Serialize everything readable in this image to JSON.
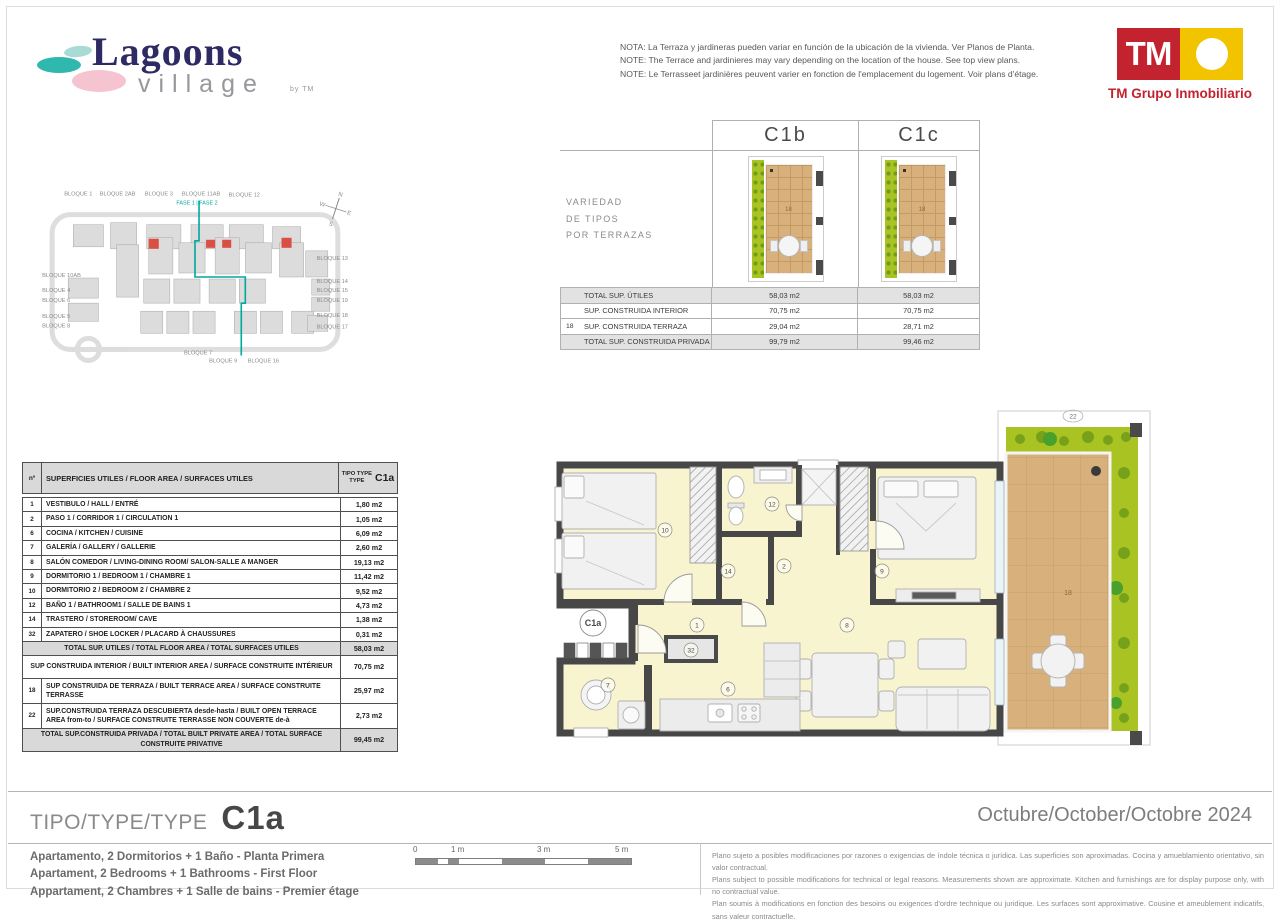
{
  "brand": {
    "name": "Lagoons",
    "sub": "village",
    "by": "by TM",
    "tm": "TM",
    "company": "TM Grupo Inmobiliario"
  },
  "notes": [
    "NOTA: La Terraza y jardineras pueden variar en función de la ubicación de la vivienda. Ver Planos de Planta.",
    "NOTE: The Terrace and jardinieres may vary depending on the location of the house. See top view plans.",
    "NOTE: Le Terrasseet jardinières peuvent varier en fonction de l'emplacement du logement. Voir plans d'étage."
  ],
  "site_plan": {
    "fase": "FASE 1 | FASE 2",
    "compass": {
      "n": "N",
      "s": "S",
      "e": "E",
      "w": "W"
    },
    "labels": [
      {
        "text": "BLOQUE 1",
        "x": 50,
        "y": 13,
        "anchor": "middle"
      },
      {
        "text": "BLOQUE 2AB",
        "x": 89,
        "y": 13,
        "anchor": "middle"
      },
      {
        "text": "BLOQUE 3",
        "x": 130,
        "y": 13,
        "anchor": "middle"
      },
      {
        "text": "BLOQUE 11AB",
        "x": 172,
        "y": 13,
        "anchor": "middle"
      },
      {
        "text": "BLOQUE 12",
        "x": 215,
        "y": 14,
        "anchor": "middle"
      },
      {
        "text": "BLOQUE 10AB",
        "x": 14,
        "y": 94,
        "anchor": "start"
      },
      {
        "text": "BLOQUE 4",
        "x": 14,
        "y": 109,
        "anchor": "start"
      },
      {
        "text": "BLOQUE 6",
        "x": 14,
        "y": 119,
        "anchor": "start"
      },
      {
        "text": "BLOQUE 5",
        "x": 14,
        "y": 135,
        "anchor": "start"
      },
      {
        "text": "BLOQUE 8",
        "x": 14,
        "y": 144,
        "anchor": "start"
      },
      {
        "text": "BLOQUE 13",
        "x": 318,
        "y": 77,
        "anchor": "end"
      },
      {
        "text": "BLOQUE 14",
        "x": 318,
        "y": 100,
        "anchor": "end"
      },
      {
        "text": "BLOQUE 15",
        "x": 318,
        "y": 109,
        "anchor": "end"
      },
      {
        "text": "BLOQUE 19",
        "x": 318,
        "y": 119,
        "anchor": "end"
      },
      {
        "text": "BLOQUE 18",
        "x": 318,
        "y": 134,
        "anchor": "end"
      },
      {
        "text": "BLOQUE 17",
        "x": 318,
        "y": 145,
        "anchor": "end"
      },
      {
        "text": "BLOQUE 7",
        "x": 169,
        "y": 171,
        "anchor": "middle"
      },
      {
        "text": "BLOQUE 9",
        "x": 194,
        "y": 179,
        "anchor": "middle"
      },
      {
        "text": "BLOQUE 16",
        "x": 234,
        "y": 179,
        "anchor": "middle"
      }
    ]
  },
  "variants": {
    "heading": [
      "VARIEDAD",
      "DE TIPOS",
      "POR TERRAZAS"
    ],
    "columns": [
      "C1b",
      "C1c"
    ],
    "terrace_room_number": "18",
    "rows": [
      {
        "n": "",
        "label": "TOTAL SUP. ÚTILES",
        "c1b": "58,03 m2",
        "c1c": "58,03 m2",
        "shaded": true
      },
      {
        "n": "",
        "label": "SUP. CONSTRUIDA INTERIOR",
        "c1b": "70,75 m2",
        "c1c": "70,75 m2",
        "shaded": false
      },
      {
        "n": "18",
        "label": "SUP. CONSTRUIDA TERRAZA",
        "c1b": "29,04 m2",
        "c1c": "28,71 m2",
        "shaded": false
      },
      {
        "n": "",
        "label": "TOTAL SUP. CONSTRUIDA PRIVADA",
        "c1b": "99,79 m2",
        "c1c": "99,46 m2",
        "shaded": true
      }
    ]
  },
  "surfaces": {
    "col_n": "nº",
    "col_label": "SUPERFICIES UTILES / FLOOR AREA / SURFACES UTILES",
    "col_tipo_lines": [
      "TIPO TYPE",
      "TYPE"
    ],
    "col_tipo_value": "C1a",
    "rows": [
      {
        "n": "1",
        "label": "VESTIBULO / HALL / ENTRÉ",
        "value": "1,80 m2",
        "kind": "plain"
      },
      {
        "n": "2",
        "label": "PASO 1 / CORRIDOR 1 / CIRCULATION 1",
        "value": "1,05 m2",
        "kind": "plain"
      },
      {
        "n": "6",
        "label": "COCINA / KITCHEN / CUISINE",
        "value": "6,09 m2",
        "kind": "plain"
      },
      {
        "n": "7",
        "label": "GALERÍA / GALLERY / GALLERIE",
        "value": "2,60 m2",
        "kind": "plain"
      },
      {
        "n": "8",
        "label": "SALÓN COMEDOR  / LIVING-DINING ROOM/ SALON-SALLE A MANGER",
        "value": "19,13 m2",
        "kind": "plain"
      },
      {
        "n": "9",
        "label": "DORMITORIO 1 / BEDROOM 1 / CHAMBRE 1",
        "value": "11,42 m2",
        "kind": "plain"
      },
      {
        "n": "10",
        "label": "DORMITORIO 2 / BEDROOM 2 / CHAMBRE 2",
        "value": "9,52 m2",
        "kind": "plain"
      },
      {
        "n": "12",
        "label": "BAÑO 1 / BATHROOM1 / SALLE DE BAINS 1",
        "value": "4,73 m2",
        "kind": "plain"
      },
      {
        "n": "14",
        "label": "TRASTERO / STOREROOM/ CAVE",
        "value": "1,38 m2",
        "kind": "plain"
      },
      {
        "n": "32",
        "label": "ZAPATERO / SHOE LOCKER / PLACARD À CHAUSSURES",
        "value": "0,31 m2",
        "kind": "plain"
      },
      {
        "n": "",
        "label": "TOTAL SUP. UTILES / TOTAL FLOOR AREA / TOTAL SURFACES UTILES",
        "value": "58,03 m2",
        "kind": "total"
      },
      {
        "n": "",
        "label": "SUP CONSTRUIDA INTERIOR / BUILT INTERIOR AREA /  SURFACE CONSTRUITE INTÉRIEUR",
        "value": "70,75 m2",
        "kind": "center2"
      },
      {
        "n": "18",
        "label": "SUP CONSTRUIDA  DE TERRAZA  / BUILT TERRACE  AREA / SURFACE CONSTRUITE TERRASSE",
        "value": "25,97 m2",
        "kind": "tall"
      },
      {
        "n": "22",
        "label": "SUP.CONSTRUIDA TERRAZA DESCUBIERTA desde-hasta / BUILT OPEN TERRACE AREA from-to / SURFACE CONSTRUITE TERRASSE NON COUVERTE de-à",
        "value": "2,73 m2",
        "kind": "tall"
      },
      {
        "n": "",
        "label": "TOTAL SUP.CONSTRUIDA PRIVADA / TOTAL  BUILT PRIVATE AREA / TOTAL SURFACE CONSTRUITE PRIVATIVE",
        "value": "99,45 m2",
        "kind": "total"
      }
    ]
  },
  "floor_plan": {
    "unit": "C1a",
    "terrace_number": "18",
    "jardiniere_number": "22",
    "room_labels": [
      {
        "id": "10",
        "x": 125,
        "y": 127
      },
      {
        "id": "12",
        "x": 232,
        "y": 101
      },
      {
        "id": "14",
        "x": 188,
        "y": 168
      },
      {
        "id": "2",
        "x": 244,
        "y": 163
      },
      {
        "id": "9",
        "x": 342,
        "y": 168
      },
      {
        "id": "1",
        "x": 157,
        "y": 222
      },
      {
        "id": "32",
        "x": 151,
        "y": 247
      },
      {
        "id": "7",
        "x": 68,
        "y": 282
      },
      {
        "id": "6",
        "x": 188,
        "y": 286
      },
      {
        "id": "8",
        "x": 307,
        "y": 222
      }
    ]
  },
  "footer": {
    "type_prefix": "TIPO/TYPE/TYPE",
    "type_value": "C1a",
    "date": "Octubre/October/Octobre 2024",
    "descriptions": [
      "Apartamento, 2 Dormitorios + 1 Baño - Planta Primera",
      "Apartament, 2 Bedrooms + 1 Bathrooms - First Floor",
      "Appartament, 2 Chambres + 1 Salle de bains - Premier étage"
    ],
    "scale_ticks": [
      "0",
      "1 m",
      "3 m",
      "5 m"
    ],
    "disclaimer": [
      "Plano sujeto a posibles modificaciones por razones o exigencias de índole técnica o jurídica. Las superficies son aproximadas. Cocina y amueblamiento orientativo, sin valor contractual.",
      "Plans subject to possible modifications for technical or legal reasons. Measurements shown are approximate. Kitchen and furnishings are for display purpose only, with no contractual value.",
      "Plan soumis à modifications en fonction des besoins ou exigences d'ordre technique ou juridique. Les surfaces sont approximative. Cousine et ameublement indicatifs, sans valeur contractuelle."
    ]
  },
  "colors": {
    "tm_red": "#C2232E",
    "tm_yellow": "#F2C400",
    "teal": "#00A99D",
    "navy": "#2E2A63",
    "pink": "#F6C3D0",
    "wall": "#474747",
    "floor": "#F8F4D0",
    "terrace": "#D8B07B",
    "garden": "#A8C322",
    "shade": "#DCDCDC"
  }
}
